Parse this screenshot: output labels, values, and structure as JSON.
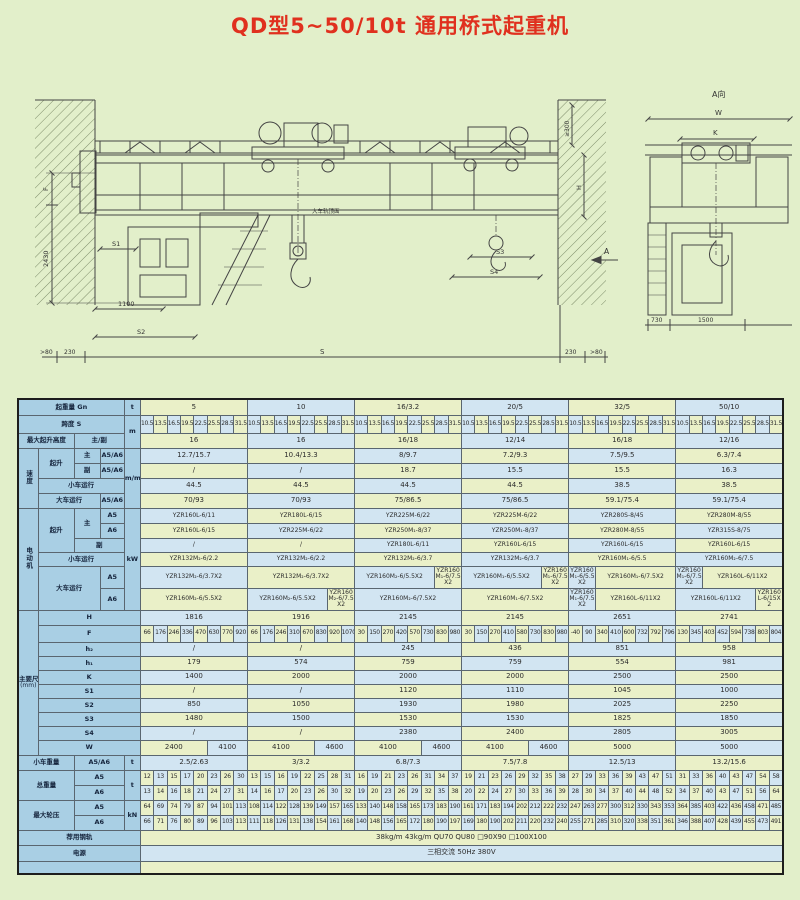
{
  "page": {
    "title": "QD型5~50/10t 通用桥式起重机"
  },
  "colors": {
    "page_bg": "#e2efca",
    "title_red": "#e0301e",
    "cell_green": "#eaf0c8",
    "cell_blue": "#d2e5f2",
    "header_blue": "#a9cfe4",
    "line": "#444444"
  },
  "drawing": {
    "labels": {
      "f": "F",
      "h2430": "2430",
      "s1": "S1",
      "d1100": "1100",
      "s2": "S2",
      "gt80l": ">80",
      "d230l": "230",
      "s": "S",
      "d230r": "230",
      "gt80r": ">80",
      "ge300": "≥300",
      "h": "H",
      "s3": "S3",
      "s4": "S4",
      "a": "A",
      "a_view": "A向",
      "w": "W",
      "k": "K",
      "d730": "730",
      "d1500": "1500",
      "rail_note": "大车轨顶面"
    }
  },
  "table": {
    "columns": [
      "5",
      "10",
      "16/3.2",
      "20/5",
      "32/5",
      "50/10"
    ],
    "rows": [
      {
        "h": 16,
        "lead": [
          {
            "t": "起重量 Gn",
            "cs": 4
          },
          {
            "t": "t"
          }
        ],
        "span": 8,
        "cells": [
          "5",
          "10",
          "16/3.2",
          "20/5",
          "32/5",
          "50/10"
        ]
      },
      {
        "h": 18,
        "small": true,
        "lead": [
          {
            "t": "跨度 S",
            "cs": 4
          },
          {
            "t": "m",
            "rs": 2
          }
        ],
        "span": 1,
        "cells": [
          "10.5",
          "13.5",
          "16.5",
          "19.5",
          "22.5",
          "25.5",
          "28.5",
          "31.5",
          "10.5",
          "13.5",
          "16.5",
          "19.5",
          "22.5",
          "25.5",
          "28.5",
          "31.5",
          "10.5",
          "13.5",
          "16.5",
          "19.5",
          "22.5",
          "25.5",
          "28.5",
          "31.5",
          "10.5",
          "13.5",
          "16.5",
          "19.5",
          "22.5",
          "25.5",
          "28.5",
          "31.5",
          "10.5",
          "13.5",
          "16.5",
          "19.5",
          "22.5",
          "25.5",
          "28.5",
          "31.5",
          "10.5",
          "13.5",
          "16.5",
          "19.5",
          "22.5",
          "25.5",
          "28.5",
          "31.5"
        ]
      },
      {
        "h": 15,
        "lead": [
          {
            "t": "最大起升高度",
            "cs": 2
          },
          {
            "t": "主/副",
            "cs": 2
          }
        ],
        "span": 8,
        "cells": [
          "16",
          "16",
          "16/18",
          "12/14",
          "16/18",
          "12/16"
        ]
      },
      {
        "h": 15,
        "lead": [
          {
            "t": "速度",
            "rs": 4,
            "vert": true
          },
          {
            "t": "起升",
            "rs": 2
          },
          {
            "t": "主"
          },
          {
            "t": "A5/A6"
          },
          {
            "t": "m/min",
            "rs": 4
          }
        ],
        "span": 8,
        "cells": [
          "12.7/15.7",
          "10.4/13.3",
          "8/9.7",
          "7.2/9.3",
          "7.5/9.5",
          "6.3/7.4"
        ]
      },
      {
        "h": 15,
        "lead": [
          {
            "t": "副"
          },
          {
            "t": "A5/A6"
          }
        ],
        "span": 8,
        "cells": [
          "/",
          "/",
          "18.7",
          "15.5",
          "15.5",
          "16.3"
        ]
      },
      {
        "h": 15,
        "lead": [
          {
            "t": "小车运行",
            "cs": 3
          }
        ],
        "span": 8,
        "cells": [
          "44.5",
          "44.5",
          "44.5",
          "44.5",
          "38.5",
          "38.5"
        ]
      },
      {
        "h": 15,
        "lead": [
          {
            "t": "大车运行",
            "cs": 2
          },
          {
            "t": "A5/A6"
          }
        ],
        "span": 8,
        "cells": [
          "70/93",
          "70/93",
          "75/86.5",
          "75/86.5",
          "59.1/75.4",
          "59.1/75.4"
        ]
      },
      {
        "h": 15,
        "mot": true,
        "lead": [
          {
            "t": "电动机",
            "rs": 6,
            "vert": true
          },
          {
            "t": "起升",
            "rs": 3
          },
          {
            "t": "主",
            "rs": 2
          },
          {
            "t": "A5"
          },
          {
            "t": "kW",
            "rs": 6
          }
        ],
        "span": 8,
        "cells": [
          "YZR160L-6/11",
          "YZR180L-6/15",
          "YZR225M-6/22",
          "YZR225M-6/22",
          "YZR280S-8/45",
          "YZR280M-8/55"
        ]
      },
      {
        "h": 15,
        "mot": true,
        "lead": [
          {
            "t": "A6"
          }
        ],
        "span": 8,
        "cells": [
          "YZR160L-6/15",
          "YZR225M-6/22",
          "YZR250M₁-8/37",
          "YZR250M₁-8/37",
          "YZR280M-8/55",
          "YZR315S-8/75"
        ]
      },
      {
        "h": 14,
        "mot": true,
        "lead": [
          {
            "t": "副",
            "cs": 2
          }
        ],
        "span": 8,
        "cells": [
          "/",
          "/",
          "YZR180L-6/11",
          "YZR160L-6/15",
          "YZR160L-6/15",
          "YZR160L-6/15"
        ]
      },
      {
        "h": 14,
        "mot": true,
        "lead": [
          {
            "t": "小车运行",
            "cs": 3
          }
        ],
        "span": 8,
        "cells": [
          "YZR132M₂-6/2.2",
          "YZR132M₂-6/2.2",
          "YZR132M₂-6/3.7",
          "YZR132M₂-6/3.7",
          "YZR160M₁-6/5.5",
          "YZR160M₂-6/7.5"
        ]
      },
      {
        "h": 22,
        "mot": true,
        "lead": [
          {
            "t": "大车运行",
            "cs": 2,
            "rs": 2
          },
          {
            "t": "A5"
          }
        ],
        "cells": [
          {
            "t": "YZR132M₂-6/3.7X2",
            "s": 8
          },
          {
            "t": "YZR132M₂-6/3.7X2",
            "s": 8
          },
          {
            "t": "YZR160M₂-6/5.5X2",
            "s": 6
          },
          {
            "t": "YZR160M₁-6/7.5X2",
            "s": 2
          },
          {
            "t": "YZR160M₁-6/5.5X2",
            "s": 6
          },
          {
            "t": "YZR160M₁-6/7.5X2",
            "s": 2
          },
          {
            "t": "YZR160M₁-6/5.5X2",
            "s": 2
          },
          {
            "t": "YZR160M₁-6/7.5X2",
            "s": 6
          },
          {
            "t": "YZR160M₁-6/7.5X2",
            "s": 2
          },
          {
            "t": "YZR160L-6/11X2",
            "s": 6
          }
        ]
      },
      {
        "h": 22,
        "mot": true,
        "lead": [
          {
            "t": "A6"
          }
        ],
        "cells": [
          {
            "t": "YZR160M₂-6/5.5X2",
            "s": 8
          },
          {
            "t": "YZR160M₂-6/5.5X2",
            "s": 6
          },
          {
            "t": "YZR160M₂-6/7.5X2",
            "s": 2
          },
          {
            "t": "YZR160M₂-6/7.5X2",
            "s": 8
          },
          {
            "t": "YZR160M₁-6/7.5X2",
            "s": 8
          },
          {
            "t": "YZR160M₁-6/7.5X2",
            "s": 2
          },
          {
            "t": "YZR160L-6/11X2",
            "s": 6
          },
          {
            "t": "YZR160L-6/11X2",
            "s": 6
          },
          {
            "t": "YZR160L-6/15X2",
            "s": 2
          }
        ]
      },
      {
        "h": 15,
        "lead": [
          {
            "t": "主要尺寸",
            "sub": "(mm)",
            "rs": 10
          },
          {
            "t": "H",
            "cs": 4
          }
        ],
        "span": 8,
        "cells": [
          "1816",
          "1916",
          "2145",
          "2145",
          "2651",
          "2741"
        ]
      },
      {
        "h": 17,
        "small": true,
        "lead": [
          {
            "t": "F",
            "cs": 4
          }
        ],
        "span": 1,
        "cells": [
          "66",
          "176",
          "246",
          "336",
          "470",
          "630",
          "770",
          "920",
          "66",
          "176",
          "246",
          "310",
          "670",
          "830",
          "920",
          "1070",
          "30",
          "150",
          "270",
          "420",
          "570",
          "730",
          "830",
          "980",
          "30",
          "150",
          "270",
          "410",
          "580",
          "730",
          "830",
          "980",
          "-40",
          "90",
          "340",
          "410",
          "600",
          "732",
          "792",
          "796",
          "130",
          "345",
          "403",
          "452",
          "594",
          "738",
          "803",
          "804"
        ]
      },
      {
        "h": 14,
        "lead": [
          {
            "t": "h₂",
            "cs": 4
          }
        ],
        "span": 8,
        "cells": [
          "/",
          "/",
          "245",
          "436",
          "851",
          "958"
        ]
      },
      {
        "h": 14,
        "lead": [
          {
            "t": "h₁",
            "cs": 4
          }
        ],
        "span": 8,
        "cells": [
          "179",
          "574",
          "759",
          "759",
          "554",
          "981"
        ]
      },
      {
        "h": 14,
        "lead": [
          {
            "t": "K",
            "cs": 4
          }
        ],
        "span": 8,
        "cells": [
          "1400",
          "2000",
          "2000",
          "2000",
          "2500",
          "2500"
        ]
      },
      {
        "h": 14,
        "lead": [
          {
            "t": "S1",
            "cs": 4
          }
        ],
        "span": 8,
        "cells": [
          "/",
          "/",
          "1120",
          "1110",
          "1045",
          "1000"
        ]
      },
      {
        "h": 14,
        "lead": [
          {
            "t": "S2",
            "cs": 4
          }
        ],
        "span": 8,
        "cells": [
          "850",
          "1050",
          "1930",
          "1980",
          "2025",
          "2250"
        ]
      },
      {
        "h": 14,
        "lead": [
          {
            "t": "S3",
            "cs": 4
          }
        ],
        "span": 8,
        "cells": [
          "1480",
          "1500",
          "1530",
          "1530",
          "1825",
          "1850"
        ]
      },
      {
        "h": 14,
        "lead": [
          {
            "t": "S4",
            "cs": 4
          }
        ],
        "span": 8,
        "cells": [
          "/",
          "/",
          "2380",
          "2400",
          "2805",
          "3005"
        ]
      },
      {
        "h": 15,
        "lead": [
          {
            "t": "W",
            "cs": 4
          }
        ],
        "cells": [
          {
            "t": "2400",
            "s": 5
          },
          {
            "t": "4100",
            "s": 3
          },
          {
            "t": "4100",
            "s": 5
          },
          {
            "t": "4600",
            "s": 3
          },
          {
            "t": "4100",
            "s": 5
          },
          {
            "t": "4600",
            "s": 3
          },
          {
            "t": "4100",
            "s": 5
          },
          {
            "t": "4600",
            "s": 3
          },
          {
            "t": "5000",
            "s": 8
          },
          {
            "t": "5000",
            "s": 8
          }
        ]
      },
      {
        "h": 15,
        "lead": [
          {
            "t": "小车重量",
            "cs": 2
          },
          {
            "t": "A5/A6",
            "cs": 2
          },
          {
            "t": "t"
          }
        ],
        "span": 8,
        "cells": [
          "2.5/2.63",
          "3/3.2",
          "6.8/7.3",
          "7.5/7.8",
          "12.5/13",
          "13.2/15.6"
        ]
      },
      {
        "h": 15,
        "small": true,
        "lead": [
          {
            "t": "总重量",
            "cs": 2,
            "rs": 2
          },
          {
            "t": "A5",
            "cs": 2
          },
          {
            "t": "t",
            "rs": 2
          }
        ],
        "span": 1,
        "cells": [
          "12",
          "13",
          "15",
          "17",
          "20",
          "23",
          "26",
          "30",
          "13",
          "15",
          "16",
          "19",
          "22",
          "25",
          "28",
          "31",
          "16",
          "19",
          "21",
          "23",
          "26",
          "31",
          "34",
          "37",
          "19",
          "21",
          "23",
          "26",
          "29",
          "32",
          "35",
          "38",
          "27",
          "29",
          "33",
          "36",
          "39",
          "43",
          "47",
          "51",
          "31",
          "33",
          "36",
          "40",
          "43",
          "47",
          "54",
          "58"
        ]
      },
      {
        "h": 15,
        "small": true,
        "lead": [
          {
            "t": "A6",
            "cs": 2
          }
        ],
        "span": 1,
        "cells": [
          "13",
          "14",
          "16",
          "18",
          "21",
          "24",
          "27",
          "31",
          "14",
          "16",
          "17",
          "20",
          "23",
          "26",
          "30",
          "32",
          "19",
          "20",
          "23",
          "26",
          "29",
          "32",
          "35",
          "38",
          "20",
          "22",
          "24",
          "27",
          "30",
          "33",
          "36",
          "39",
          "28",
          "30",
          "34",
          "37",
          "40",
          "44",
          "48",
          "52",
          "34",
          "37",
          "40",
          "43",
          "47",
          "51",
          "56",
          "64"
        ]
      },
      {
        "h": 15,
        "small": true,
        "lead": [
          {
            "t": "最大轮压",
            "cs": 2,
            "rs": 2
          },
          {
            "t": "A5",
            "cs": 2
          },
          {
            "t": "kN",
            "rs": 2
          }
        ],
        "span": 1,
        "cells": [
          "64",
          "69",
          "74",
          "79",
          "87",
          "94",
          "101",
          "113",
          "108",
          "114",
          "122",
          "128",
          "139",
          "149",
          "157",
          "165",
          "133",
          "140",
          "148",
          "158",
          "165",
          "173",
          "183",
          "190",
          "161",
          "171",
          "183",
          "194",
          "202",
          "212",
          "222",
          "232",
          "247",
          "263",
          "277",
          "300",
          "312",
          "330",
          "343",
          "353",
          "364",
          "385",
          "403",
          "422",
          "436",
          "458",
          "471",
          "485"
        ]
      },
      {
        "h": 15,
        "small": true,
        "lead": [
          {
            "t": "A6",
            "cs": 2
          }
        ],
        "span": 1,
        "cells": [
          "66",
          "71",
          "76",
          "80",
          "89",
          "96",
          "103",
          "113",
          "111",
          "118",
          "126",
          "131",
          "138",
          "154",
          "161",
          "168",
          "140",
          "148",
          "156",
          "165",
          "172",
          "180",
          "190",
          "197",
          "169",
          "180",
          "190",
          "202",
          "211",
          "220",
          "232",
          "240",
          "255",
          "271",
          "285",
          "310",
          "320",
          "338",
          "351",
          "361",
          "346",
          "388",
          "407",
          "428",
          "439",
          "455",
          "473",
          "491"
        ]
      },
      {
        "h": 15,
        "lead": [
          {
            "t": "荐用钢轨",
            "cs": 5
          }
        ],
        "cells": [
          {
            "t": "38kg/m  43kg/m  QU70  QU80  □90X90  □100X100",
            "s": 48
          }
        ]
      },
      {
        "h": 16,
        "lead": [
          {
            "t": "电源",
            "cs": 5
          }
        ],
        "cells": [
          {
            "t": "三相交流  50Hz  380V",
            "s": 48
          }
        ]
      },
      {
        "h": 13,
        "lead": [
          {
            "t": "",
            "cs": 5
          }
        ],
        "cells": [
          {
            "t": "",
            "s": 48
          }
        ]
      }
    ]
  }
}
